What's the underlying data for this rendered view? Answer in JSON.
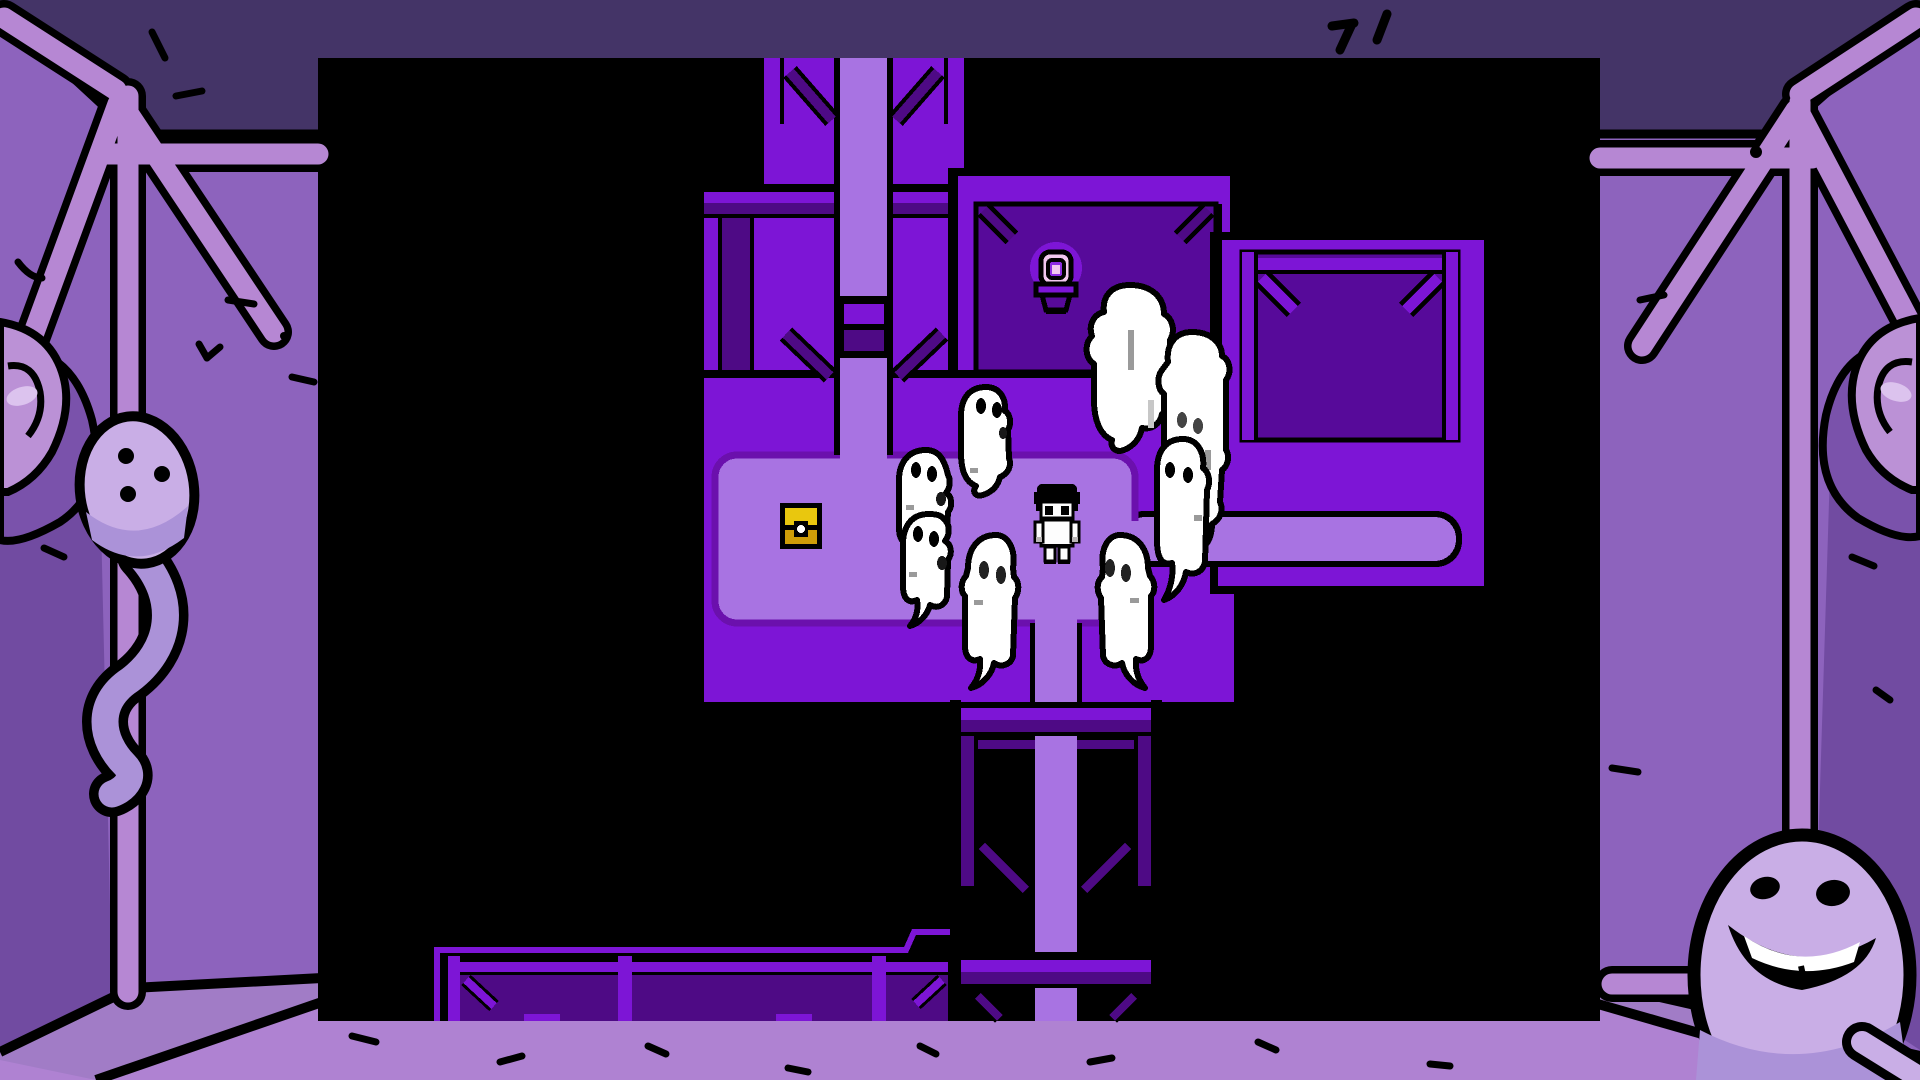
{
  "scene": {
    "description": "Top-down pixel RPG dungeon: a player character surrounded by eight white ghosts next to a gold treasure chest, a glowing lamp shrine and connected purple rooms, framed by a hand-drawn purple room border with a tadpole ghost on the left and a smiling egg ghost on the right.",
    "counts": {
      "pixel_ghosts": 8,
      "border_ghosts": 2,
      "treasure_chests": 1,
      "lamps": 1,
      "doors": 1,
      "players": 1
    }
  },
  "palette": {
    "outline": "#000000",
    "border_wall": "#8d63bd",
    "border_wall_dark": "#714ba1",
    "border_blob": "#7a52ab",
    "ceiling": "#443467",
    "floor": "#af82d2",
    "floor_band": "#a17cc6",
    "pole": "#b687d3",
    "ghost_light": "#c9aee6",
    "ghost_shade": "#ab92d8",
    "ear": "#bb91d6",
    "ear_highlight": "#dcc3ee",
    "game_wall": "#7d15d6",
    "game_path": "#a873e2",
    "game_room_dark": "#570a9a",
    "game_beam_dark": "#4e0a85",
    "game_floor_rim": "#6b10ad",
    "chest_lid": "#e9c70e",
    "chest_body": "#cf9d08",
    "lamp_pink": "#f2c8ef",
    "lamp_core": "#8d2ce2",
    "sprite_white": "#fdfdfd",
    "sprite_gray": "#b9b5b5",
    "ghost_white": "#ffffff",
    "smudge": "#9a9a9a"
  }
}
